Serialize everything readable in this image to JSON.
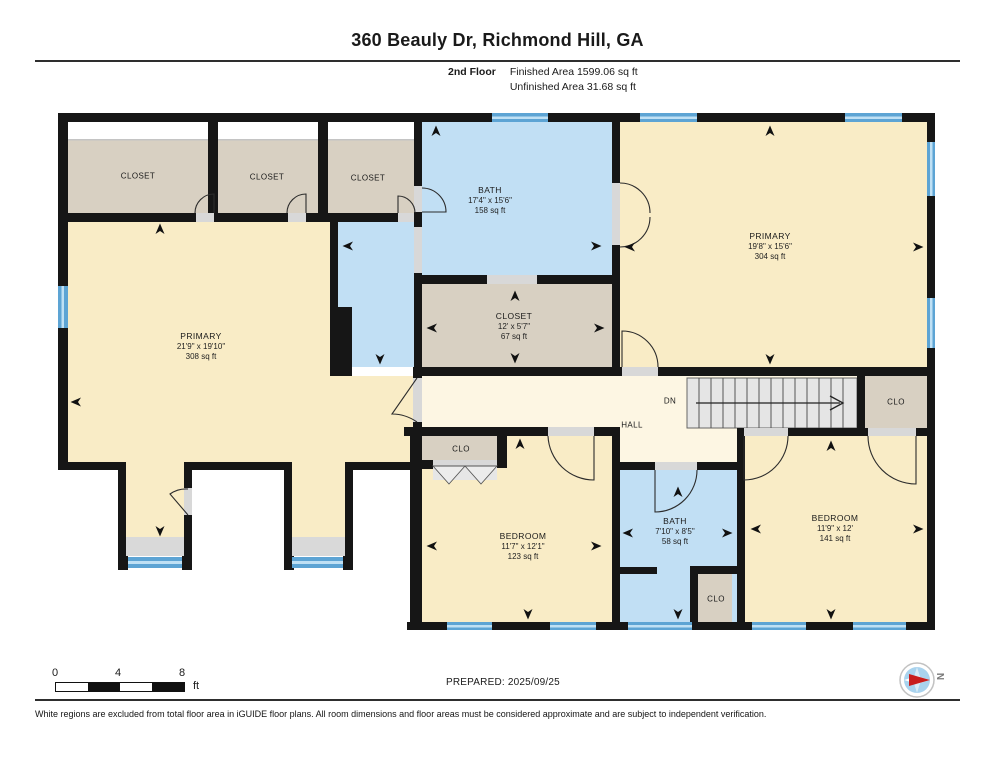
{
  "header": {
    "title": "360 Beauly Dr, Richmond Hill, GA",
    "floor_label": "2nd Floor",
    "finished_area": "Finished Area 1599.06 sq ft",
    "unfinished_area": "Unfinished Area 31.68 sq ft"
  },
  "rooms": {
    "closet_top_1": {
      "name": "CLOSET"
    },
    "closet_top_2": {
      "name": "CLOSET"
    },
    "closet_top_3": {
      "name": "CLOSET"
    },
    "bath_top": {
      "name": "BATH",
      "dims": "17'4\" x 15'6\"",
      "area": "158 sq ft"
    },
    "primary_right": {
      "name": "PRIMARY",
      "dims": "19'8\" x 15'6\"",
      "area": "304 sq ft"
    },
    "primary_left": {
      "name": "PRIMARY",
      "dims": "21'9\" x 19'10\"",
      "area": "308 sq ft"
    },
    "closet_mid": {
      "name": "CLOSET",
      "dims": "12' x 5'7\"",
      "area": "67 sq ft"
    },
    "hall": {
      "name": "HALL",
      "down_label": "DN"
    },
    "clo_hall_left": {
      "name": "CLO"
    },
    "clo_hall_right": {
      "name": "CLO"
    },
    "bedroom_mid": {
      "name": "BEDROOM",
      "dims": "11'7\" x 12'1\"",
      "area": "123 sq ft"
    },
    "bath_bottom": {
      "name": "BATH",
      "dims": "7'10\" x 8'5\"",
      "area": "58 sq ft"
    },
    "clo_bath": {
      "name": "CLO"
    },
    "bedroom_right": {
      "name": "BEDROOM",
      "dims": "11'9\" x 12'",
      "area": "141 sq ft"
    }
  },
  "footer": {
    "scale": {
      "t0": "0",
      "t4": "4",
      "t8": "8",
      "unit": "ft"
    },
    "prepared": "PREPARED: 2025/09/25",
    "compass_label": "N",
    "disclaimer": "White regions are excluded from total floor area in iGUIDE floor plans. All room dimensions and floor areas must be considered approximate and are subject to independent verification."
  },
  "colors": {
    "wall": "#161616",
    "room_cream": "#f9ecc6",
    "hall_cream": "#fdf6e3",
    "closet_tan": "#d8d0c2",
    "bath_blue": "#c1dff4",
    "window_blue": "#5da4d4",
    "stairs_grey": "#e5e5e5",
    "compass_red": "#c81d1d"
  }
}
